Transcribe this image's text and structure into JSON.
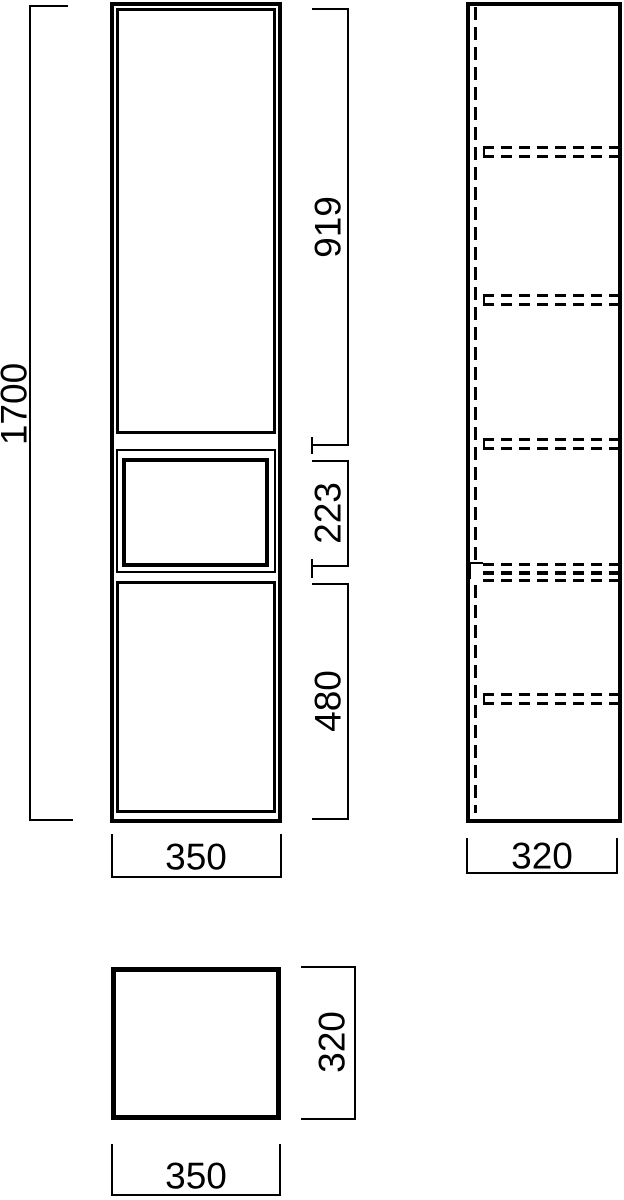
{
  "drawing": {
    "background": "#ffffff",
    "line_color": "#000000",
    "views": {
      "front": {
        "name": "front view",
        "overall_height": "1700",
        "sections": [
          {
            "part": "upper door",
            "height": "919"
          },
          {
            "part": "open shelf niche",
            "height": "223"
          },
          {
            "part": "lower door",
            "height": "480"
          }
        ],
        "width": "350"
      },
      "side": {
        "name": "side view",
        "depth": "320",
        "shelf_positions_dashed": 5
      },
      "top": {
        "name": "top view",
        "width": "350",
        "depth": "320"
      }
    }
  }
}
